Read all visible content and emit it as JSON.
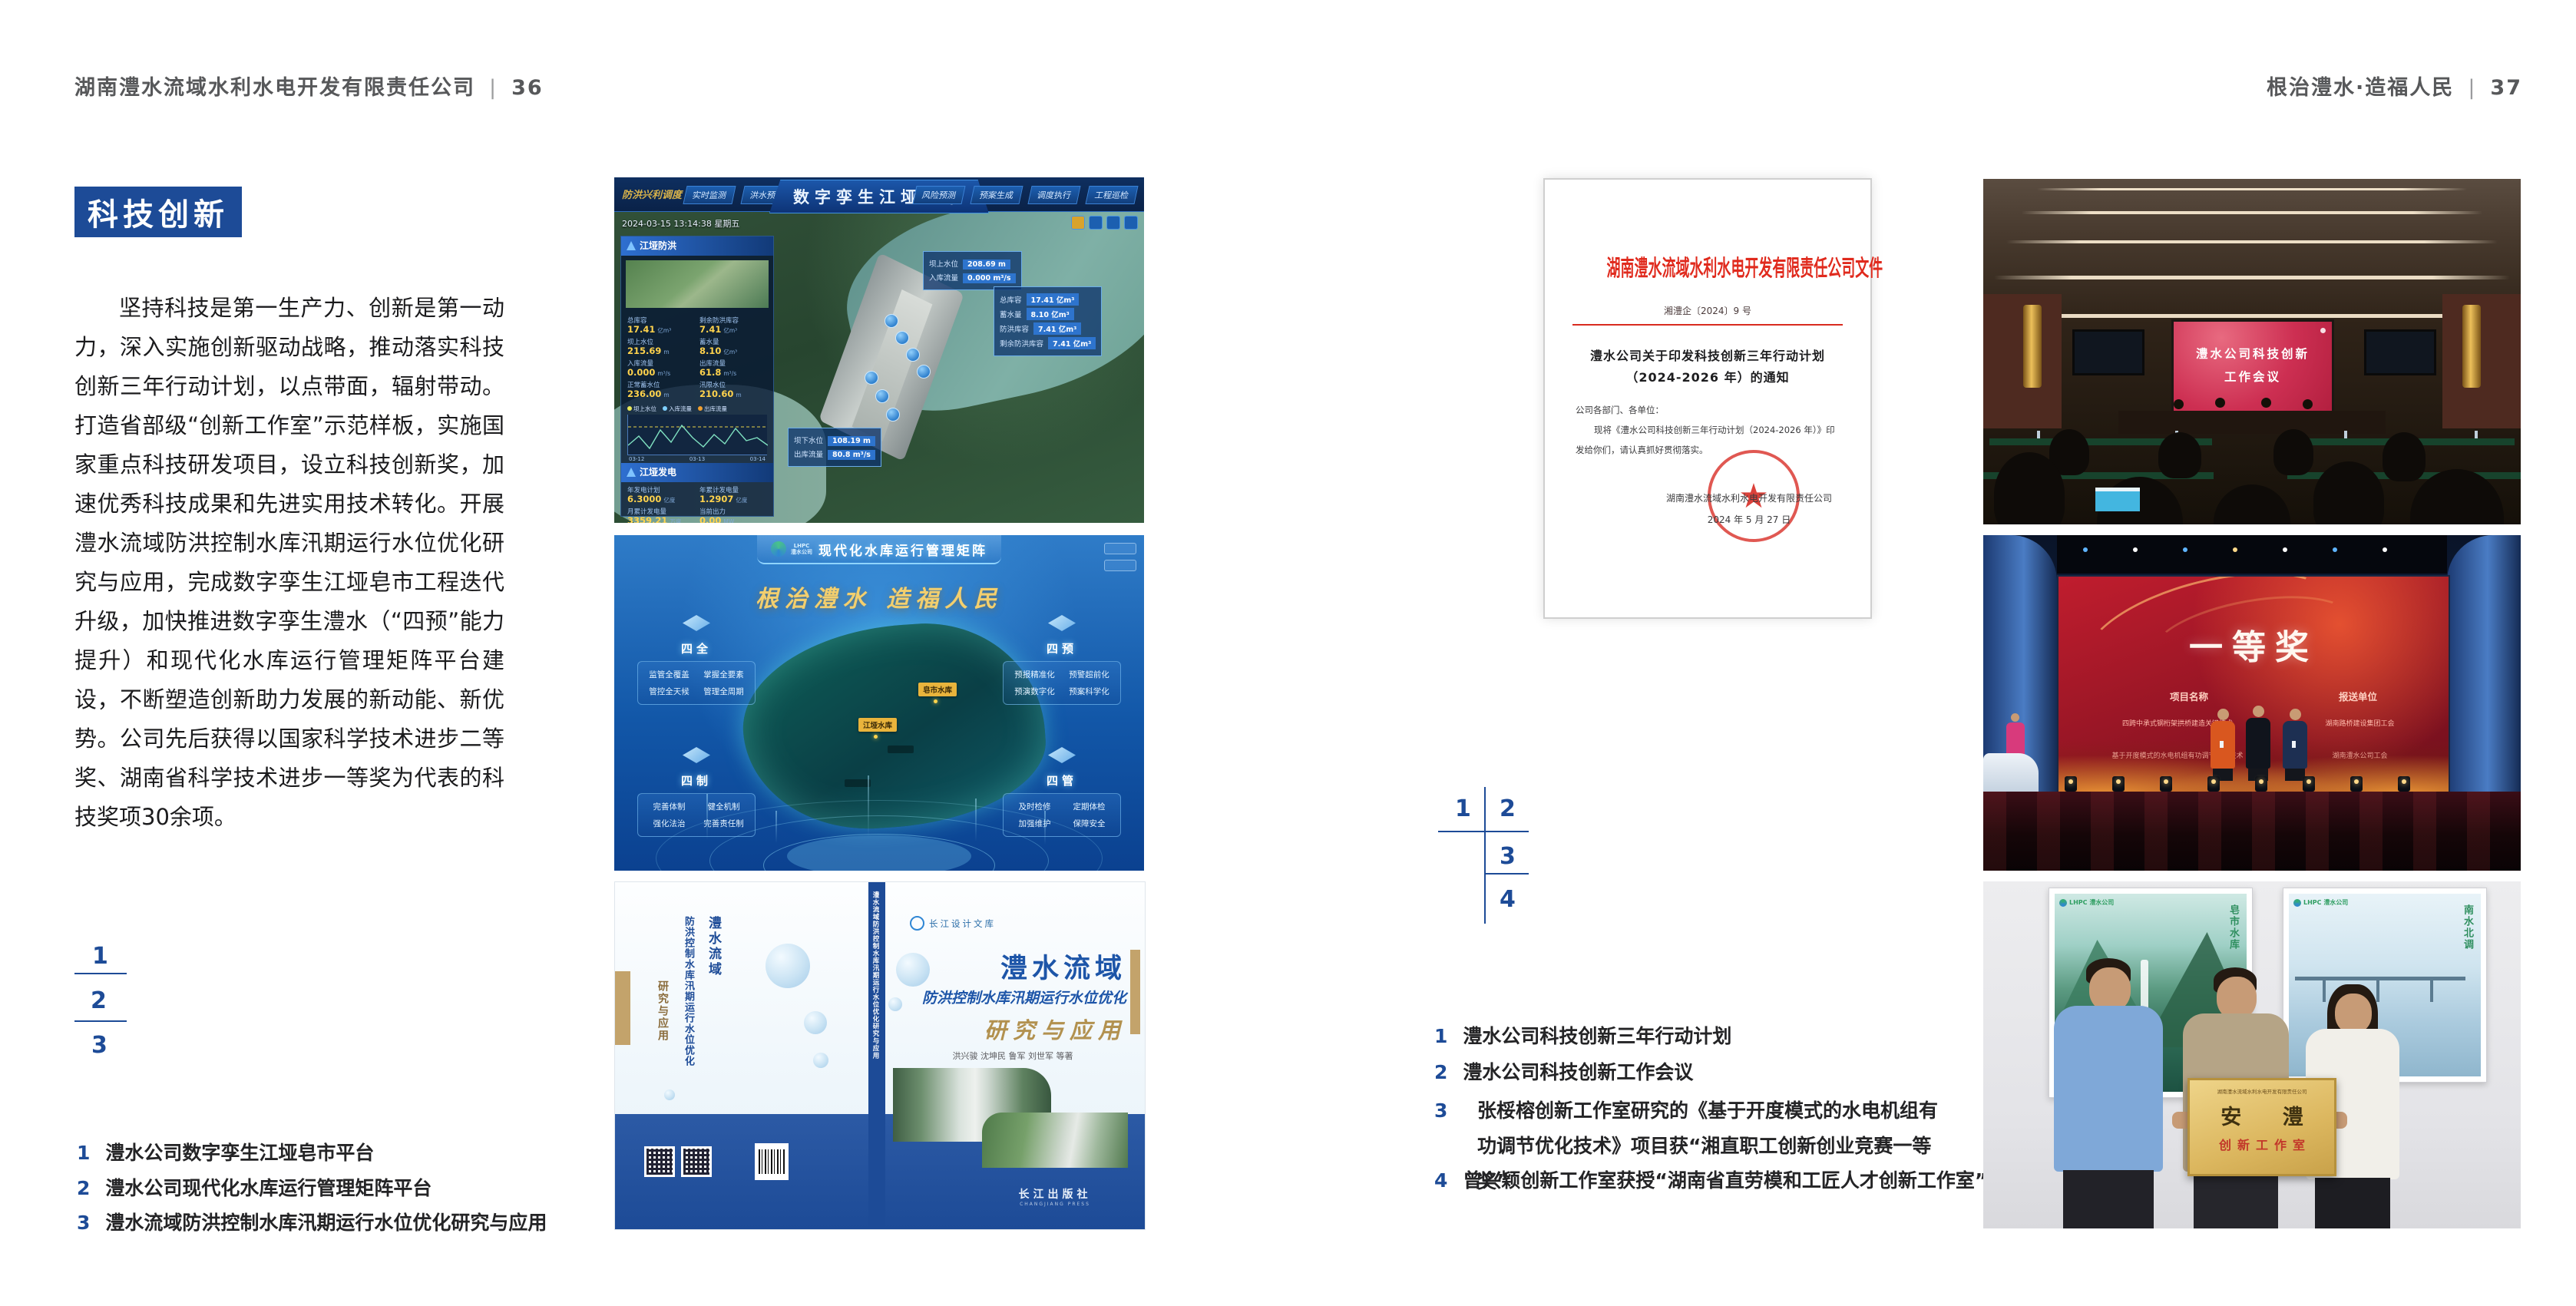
{
  "colors": {
    "accent_blue": "#1d4b97",
    "doc_red": "#e02a1d",
    "gold": "#f3cf6e"
  },
  "page_left": {
    "header": {
      "company": "湖南澧水流域水利水电开发有限责任公司",
      "sep": "|",
      "page": "36"
    },
    "badge": "科技创新",
    "paragraph": "坚持科技是第一生产力、创新是第一动力，深入实施创新驱动战略，推动落实科技创新三年行动计划，以点带面，辐射带动。打造省部级“创新工作室”示范样板，实施国家重点科技研发项目，设立科技创新奖，加速优秀科技成果和先进实用技术转化。开展澧水流域防洪控制水库汛期运行水位优化研究与应用，完成数字孪生江垭皂市工程迭代升级，加快推进数字孪生澧水（“四预”能力提升）和现代化水库运行管理矩阵平台建设，不断塑造创新助力发展的新动能、新优势。公司先后获得以国家科学技术进步二等奖、湖南省科学技术进步一等奖为代表的科技奖项30余项。",
    "figure_key": [
      "1",
      "2",
      "3"
    ],
    "captions": [
      {
        "num": "1",
        "text": "澧水公司数字孪生江垭皂市平台"
      },
      {
        "num": "2",
        "text": "澧水公司现代化水库运行管理矩阵平台"
      },
      {
        "num": "3",
        "text": "澧水流域防洪控制水库汛期运行水位优化研究与应用"
      }
    ]
  },
  "page_right": {
    "header": {
      "slogan": "根治澧水·造福人民",
      "sep": "|",
      "page": "37"
    },
    "figure_key": [
      "1",
      "2",
      "3",
      "4"
    ],
    "captions": [
      {
        "num": "1",
        "text": "澧水公司科技创新三年行动计划"
      },
      {
        "num": "2",
        "text": "澧水公司科技创新工作会议"
      },
      {
        "num": "3",
        "text": "张桵榕创新工作室研究的《基于开度模式的水电机组有功调节优化技术》项目获“湘直职工创新创业竞赛一等奖”"
      },
      {
        "num": "4",
        "text": "曾兴颖创新工作室获授“湖南省直劳模和工匠人才创新工作室”"
      }
    ]
  },
  "platform1": {
    "title": "数字孪生江垭皂市",
    "corner_label": "防洪兴利调度",
    "tabs": [
      "实时监测",
      "洪水预报",
      "防洪预警",
      "风险预测",
      "预案生成",
      "调度执行",
      "工程巡检"
    ],
    "timestamp": "2024-03-15 13:14:38 星期五",
    "panel_flood": {
      "title": "江垭防洪",
      "stats": [
        {
          "label": "总库容",
          "value": "17.41",
          "unit": "亿m³"
        },
        {
          "label": "剩余防洪库容",
          "value": "7.41",
          "unit": "亿m³"
        },
        {
          "label": "坝上水位",
          "value": "215.69",
          "unit": "m"
        },
        {
          "label": "蓄水量",
          "value": "8.10",
          "unit": "亿m³"
        },
        {
          "label": "入库流量",
          "value": "0.000",
          "unit": "m³/s"
        },
        {
          "label": "出库流量",
          "value": "61.8",
          "unit": "m³/s"
        },
        {
          "label": "正常蓄水位",
          "value": "236.00",
          "unit": "m"
        },
        {
          "label": "汛限水位",
          "value": "210.60",
          "unit": "m"
        }
      ],
      "legend": [
        "坝上水位",
        "入库流量",
        "出库流量"
      ],
      "x_ticks": [
        "03-12",
        "03-13",
        "03-14"
      ]
    },
    "panel_power": {
      "title": "江垭发电",
      "stats": [
        {
          "label": "年发电计划",
          "value": "6.3000",
          "unit": "亿度"
        },
        {
          "label": "年累计发电量",
          "value": "1.2907",
          "unit": "亿度"
        },
        {
          "label": "月累计发电量",
          "value": "3359.21",
          "unit": "万度"
        },
        {
          "label": "当前出力",
          "value": "0.00",
          "unit": "MW"
        },
        {
          "label": "发电流量",
          "value": "0.00",
          "unit": "m³/s"
        },
        {
          "label": "弃水流量",
          "value": "0.00",
          "unit": "m³/s"
        }
      ],
      "gauges": [
        "0.00",
        "102.98",
        "0.00"
      ]
    },
    "callout1": [
      {
        "label": "坝上水位",
        "value": "208.69 m"
      },
      {
        "label": "入库流量",
        "value": "0.000 m³/s"
      }
    ],
    "callout2": [
      {
        "label": "总库容",
        "value": "17.41 亿m³"
      },
      {
        "label": "蓄水量",
        "value": "8.10 亿m³"
      },
      {
        "label": "防洪库容",
        "value": "7.41 亿m³"
      },
      {
        "label": "剩余防洪库容",
        "value": "7.41 亿m³"
      }
    ],
    "callout3": [
      {
        "label": "坝下水位",
        "value": "108.19 m"
      },
      {
        "label": "出库流量",
        "value": "80.8 m³/s"
      }
    ]
  },
  "platform2": {
    "logo": "LHPC",
    "logo_sub": "澧水公司",
    "title": "现代化水库运行管理矩阵",
    "slogan": "根治澧水  造福人民",
    "map_tags": [
      "皂市水库",
      "江垭水库"
    ],
    "groups": [
      {
        "title": "四全",
        "items": [
          "监管全覆盖",
          "掌握全要素",
          "管控全天候",
          "管理全周期"
        ]
      },
      {
        "title": "四预",
        "items": [
          "预报精准化",
          "预警超前化",
          "预演数字化",
          "预案科学化"
        ]
      },
      {
        "title": "四制",
        "items": [
          "完善体制",
          "健全机制",
          "强化法治",
          "完善责任制"
        ]
      },
      {
        "title": "四管",
        "items": [
          "及时检修",
          "定期体检",
          "加强维护",
          "保障安全"
        ]
      }
    ]
  },
  "book": {
    "series": "长江设计文库",
    "title1": "澧水流域",
    "title2": "防洪控制水库汛期运行水位优化",
    "title3": "研究与应用",
    "authors": "洪兴骏  沈坤民  鲁军  刘世军  等著",
    "spine": "澧水流域防洪控制水库汛期运行水位优化研究与应用",
    "publisher": "长江出版社",
    "publisher_en": "CHANGJIANG PRESS"
  },
  "doc": {
    "header": "湖南澧水流域水利水电开发有限责任公司文件",
    "number": "湘澧企〔2024〕9 号",
    "title1": "澧水公司关于印发科技创新三年行动计划",
    "title2": "（2024-2026 年）的通知",
    "salutation": "公司各部门、各单位：",
    "body1": "现将《澧水公司科技创新三年行动计划（2024-2026 年）》印",
    "body2": "发给你们，请认真抓好贯彻落实。",
    "signature": "湖南澧水流域水利水电开发有限责任公司",
    "date": "2024 年 5 月 27 日",
    "star": "★"
  },
  "meeting": {
    "screen_line1": "澧水公司科技创新",
    "screen_line2": "工作会议"
  },
  "award": {
    "title": "一等奖",
    "col1": "项目名称",
    "col2": "报送单位",
    "rows": [
      {
        "project": "四跨中承式钢桁架拱桥建造关键技术",
        "org": "湖南路桥建设集团工会"
      },
      {
        "project": "基于开度模式的水电机组有功调节优化技术",
        "org": "湖南澧水公司工会"
      }
    ]
  },
  "plaque": {
    "poster1_logo": "LHPC 澧水公司",
    "poster1_caption": "皂市水库",
    "poster2_logo": "LHPC 澧水公司",
    "poster2_caption": "南水北调",
    "org": "湖南澧水流域水利水电开发有限责任公司",
    "title": "安 澧",
    "sub": "创新工作室"
  }
}
